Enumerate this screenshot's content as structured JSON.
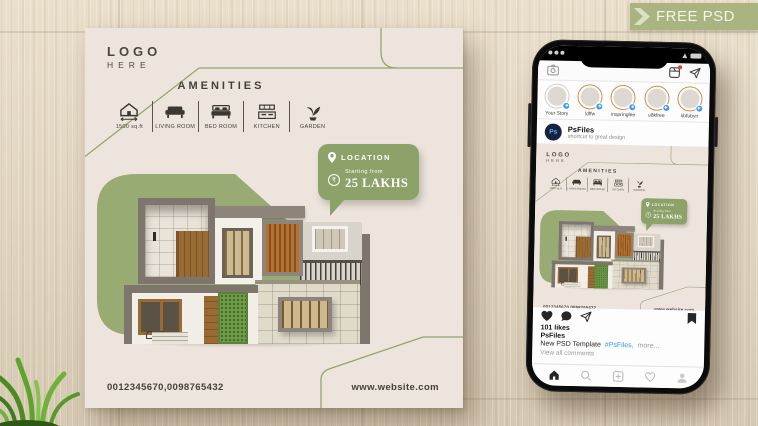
{
  "ribbon": {
    "label": "FREE PSD"
  },
  "poster": {
    "logo_line1": "LOGO",
    "logo_line2": "HERE",
    "amenities_title": "AMENITIES",
    "amenities": [
      {
        "icon": "house-area-icon",
        "label": "1500 sq.ft"
      },
      {
        "icon": "sofa-icon",
        "label": "LIVING ROOM"
      },
      {
        "icon": "bed-icon",
        "label": "BED ROOM"
      },
      {
        "icon": "kitchen-icon",
        "label": "KITCHEN"
      },
      {
        "icon": "plant-icon",
        "label": "GARDEN"
      }
    ],
    "location_badge": {
      "title": "LOCATION",
      "rupee_symbol": "₹",
      "price_prefix": "Starting from",
      "price": "25 LAKHS"
    },
    "phone_numbers": "0012345670,0098765432",
    "website": "www.website.com"
  },
  "phone": {
    "stories": [
      {
        "label": "Your Story"
      },
      {
        "label": "fdffw"
      },
      {
        "label": "inspringlee"
      },
      {
        "label": "u8kfree"
      },
      {
        "label": "kbfubyn"
      }
    ],
    "profile": {
      "avatar_text": "Ps",
      "username": "PsFiles",
      "tagline": "shortcut to great design"
    },
    "post": {
      "likes": "101 likes",
      "caption_username": "PsFiles",
      "caption_text": "New PSD Template",
      "caption_hashtag": "#PsFiles,",
      "caption_more": "more...",
      "view_comments": "View all comments"
    }
  },
  "colors": {
    "accent_green": "#98ab72",
    "badge_green": "#8da269",
    "ribbon_green": "#a9b480",
    "poster_bg": "#ede4dd",
    "hashtag_blue": "#3897f0",
    "story_ring": "#d98a3e",
    "wood": "#e0d4bf"
  }
}
